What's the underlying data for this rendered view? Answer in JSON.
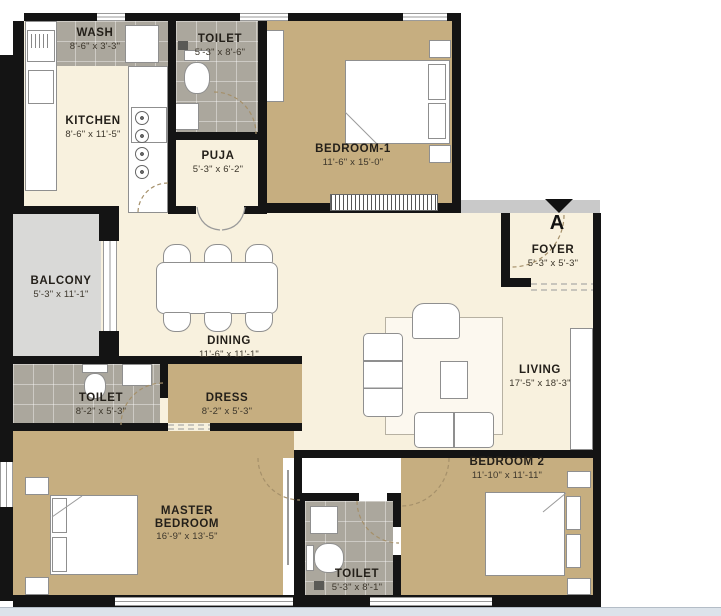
{
  "entry": {
    "marker": "A"
  },
  "rooms": {
    "wash": {
      "name": "WASH",
      "dims": "8'-6\" x 3'-3\""
    },
    "toilet1": {
      "name": "TOILET",
      "dims": "5'-3\" x 8'-6\""
    },
    "kitchen": {
      "name": "KITCHEN",
      "dims": "8'-6\" x 11'-5\""
    },
    "puja": {
      "name": "PUJA",
      "dims": "5'-3\" x 6'-2\""
    },
    "bedroom1": {
      "name": "BEDROOM-1",
      "dims": "11'-6\" x 15'-0\""
    },
    "balcony": {
      "name": "BALCONY",
      "dims": "5'-3\" x 11'-1\""
    },
    "dining": {
      "name": "DINING",
      "dims": "11'-6\" x 11'-1\""
    },
    "foyer": {
      "name": "FOYER",
      "dims": "5'-3\" x 5'-3\""
    },
    "living": {
      "name": "LIVING",
      "dims": "17'-5\" x 18'-3\""
    },
    "toilet2": {
      "name": "TOILET",
      "dims": "8'-2\" x 5'-3\""
    },
    "dress": {
      "name": "DRESS",
      "dims": "8'-2\" x 5'-3\""
    },
    "master": {
      "name": "MASTER BEDROOM",
      "dims": "16'-9\" x 13'-5\""
    },
    "toilet3": {
      "name": "TOILET",
      "dims": "5'-3\" x 8'-1\""
    },
    "bedroom2": {
      "name": "BEDROOM 2",
      "dims": "11'-10\" x 11'-11\""
    }
  },
  "colors": {
    "floor_cream": "#f8f1de",
    "floor_tan": "#c6ae80",
    "tile_gray": "#aba79d",
    "balcony_gray": "#d9d9d7",
    "wall_black": "#141414",
    "entry_strip_gray": "#c9c9c9",
    "bottom_strip_blue": "#dce3ea"
  }
}
